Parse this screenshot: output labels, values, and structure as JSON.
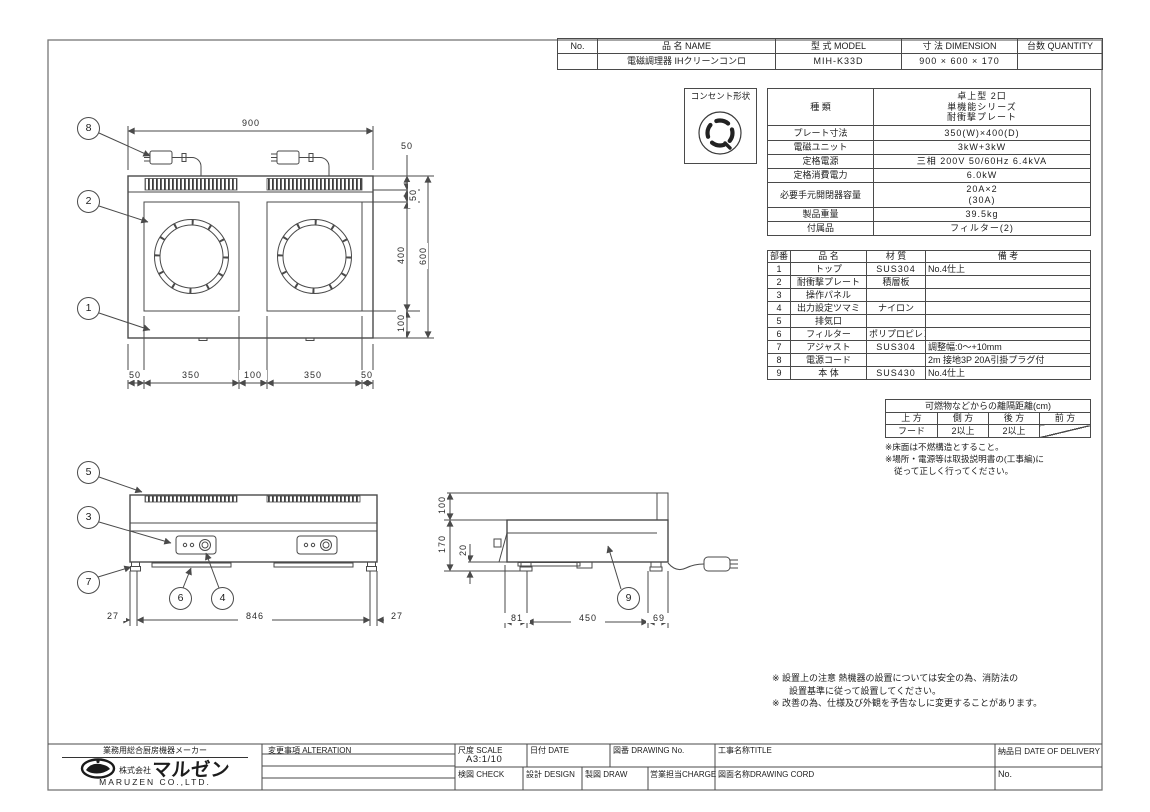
{
  "header_table": {
    "col_no": "No.",
    "col_name": "品 名  NAME",
    "col_model": "型 式  MODEL",
    "col_dimension": "寸 法  DIMENSION",
    "col_quantity": "台数 QUANTITY",
    "no": "",
    "name": "電磁調理器 IHクリーンコンロ",
    "model": "MIH-K33D",
    "dimension": "900 × 600 × 170",
    "quantity": ""
  },
  "outlet": {
    "label": "コンセント形状"
  },
  "spec_table": {
    "rows": [
      {
        "label": "種  類",
        "value": "卓上型 2口\n単機能シリーズ\n耐衝撃プレート"
      },
      {
        "label": "プレート寸法",
        "value": "350(W)×400(D)"
      },
      {
        "label": "電磁ユニット",
        "value": "3kW+3kW"
      },
      {
        "label": "定格電源",
        "value": "三相 200V 50/60Hz 6.4kVA"
      },
      {
        "label": "定格消費電力",
        "value": "6.0kW"
      },
      {
        "label": "必要手元開閉器容量",
        "value": "20A×2\n(30A)"
      },
      {
        "label": "製品重量",
        "value": "39.5kg"
      },
      {
        "label": "付属品",
        "value": "フィルター(2)"
      }
    ]
  },
  "parts_table": {
    "headers": [
      "部番",
      "品  名",
      "材  質",
      "備  考"
    ],
    "rows": [
      [
        "1",
        "トップ",
        "SUS304",
        "No.4仕上"
      ],
      [
        "2",
        "耐衝撃プレート",
        "積層板",
        ""
      ],
      [
        "3",
        "操作パネル",
        "",
        ""
      ],
      [
        "4",
        "出力設定ツマミ",
        "ナイロン",
        ""
      ],
      [
        "5",
        "排気口",
        "",
        ""
      ],
      [
        "6",
        "フィルター",
        "ポリプロピレン",
        ""
      ],
      [
        "7",
        "アジャスト",
        "SUS304",
        "調整幅:0〜+10mm"
      ],
      [
        "8",
        "電源コード",
        "",
        "2m 接地3P 20A引掛プラグ付"
      ],
      [
        "9",
        "本  体",
        "SUS430",
        "No.4仕上"
      ]
    ]
  },
  "clearance_table": {
    "title": "可燃物などからの離隔距離(cm)",
    "headers": [
      "上 方",
      "側 方",
      "後 方",
      "前 方"
    ],
    "row": [
      "フード",
      "2以上",
      "2以上",
      ""
    ],
    "notes": [
      "※床面は不燃構造とすること。",
      "※場所・電源等は取扱説明書の(工事編)に",
      "従って正しく行ってください。"
    ]
  },
  "remarks": [
    "※ 設置上の注意 熱機器の設置については安全の為、消防法の",
    "設置基準に従って設置してください。",
    "※ 改善の為、仕様及び外観を予告なしに変更することがあります。"
  ],
  "title_block": {
    "maker_tagline": "業務用総合厨房機器メーカー",
    "company_prefix": "株式会社",
    "company_name": "マルゼン",
    "company_en": "MARUZEN CO.,LTD.",
    "alteration_label": "変更事項  ALTERATION",
    "scale_label": "尺度 SCALE",
    "scale_value": "A3:1/10",
    "date_label": "日付 DATE",
    "drawing_no_label": "図番 DRAWING  No.",
    "title_label": "工事名称TITLE",
    "delivery_label": "納品日   DATE  OF  DELIVERY",
    "check_label": "検図 CHECK",
    "design_label": "設計 DESIGN",
    "draw_label": "製図 DRAW",
    "charge_label": "営業担当CHARGE",
    "drawing_name_label": "図面名称DRAWING  CORD",
    "no_label": "No."
  },
  "drawing": {
    "balloons": {
      "1": "1",
      "2": "2",
      "3": "3",
      "4": "4",
      "5": "5",
      "6": "6",
      "7": "7",
      "8": "8",
      "9": "9"
    },
    "plan": {
      "dim_width": "900",
      "dim_right_1": "50",
      "dim_right_2": "50",
      "dim_right_3": "400",
      "dim_right_4": "100",
      "dim_height": "600",
      "dim_bottom": [
        "50",
        "350",
        "100",
        "350",
        "50"
      ]
    },
    "front": {
      "dim_left": "27",
      "dim_center": "846",
      "dim_right": "27"
    },
    "side": {
      "dim_v1": "100",
      "dim_v2": "170",
      "dim_v3": "20",
      "dim_bottom": [
        "81",
        "450",
        "69"
      ]
    }
  }
}
